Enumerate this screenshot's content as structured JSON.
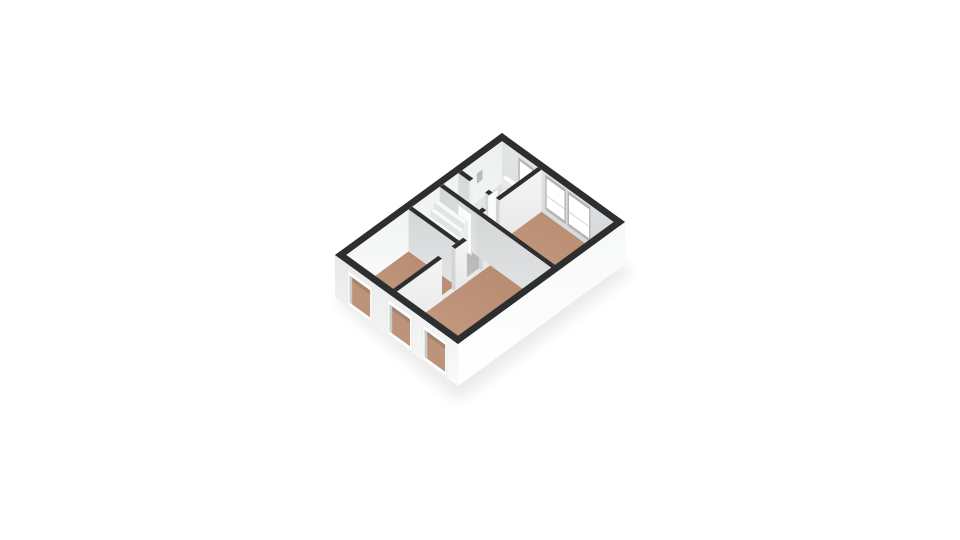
{
  "view": {
    "type": "isometric-3d-floor-plan",
    "background": "#ffffff"
  },
  "palette": {
    "wall_top": "#2c2e30",
    "face_nw_top": "#edeff0",
    "face_nw_bottom": "#fafbfb",
    "face_ne_top": "#e4e6e7",
    "face_ne_bottom": "#d3d5d7",
    "face_v_top": "#d4d6d7",
    "face_v_bottom": "#e3e4e5",
    "face_u_top": "#f4f4f4",
    "face_u_bottom": "#e7e8e8",
    "cap_se": "#eff1f1",
    "cap_sw": "#d2d4d5",
    "ext_sw_top": "#e8e9ea",
    "ext_sw_bottom": "#fafafa",
    "ext_se_top": "#f7f8f8",
    "ext_se_bottom": "#ffffff",
    "floor_wood_dark": "#b58a6f",
    "floor_wood_light": "#cc9f86",
    "floor_grey_dark": "#aeb0b2",
    "floor_grey_light": "#c8cacb",
    "floor_hall_dark": "#babcbe",
    "floor_hall_light": "#d0d2d3",
    "floor_tile_dark": "#d9dbdd",
    "floor_tile_light": "#eff0f1",
    "window_frame_int": "#b2b5b7",
    "window_pane": "#ffffff",
    "window_frame_ext": "#fdfefe",
    "window_reveal": "#c9cccd",
    "window_through_floor": "#bd9379",
    "window_through_top": "#a3846f",
    "door_leaf": "#fbfcfc",
    "door_leaf_stroke": "#d6d8d8",
    "stair_top": "#f8f9f9",
    "stair_riser": "#e2e4e5",
    "stair_side": "#eceeee",
    "stair_stroke": "#d3d5d6",
    "fixture_white": "#fdfdfd",
    "fixture_shade": "#e8eaeb",
    "fixture_stroke": "#d0d3d4",
    "sink_grey": "#b9bcbe",
    "switch_grey": "#9aa0a3",
    "shadow": "#000000"
  },
  "rooms": [
    {
      "name": "bedroom-left",
      "floor": "wood",
      "a": [
        0.034,
        0.407
      ],
      "b": [
        0.046,
        0.427
      ]
    },
    {
      "name": "stair-closet",
      "floor": "grey",
      "a": [
        0.429,
        0.593
      ],
      "b": [
        0.046,
        0.427
      ]
    },
    {
      "name": "hall",
      "floor": "hall",
      "a": [
        0.615,
        0.705
      ],
      "b": [
        0.046,
        0.337
      ]
    },
    {
      "name": "bathroom",
      "floor": "tile",
      "a": [
        0.727,
        0.966
      ],
      "b": [
        0.046,
        0.337
      ]
    },
    {
      "name": "living-room",
      "floor": "wood",
      "a": [
        0.034,
        0.593
      ],
      "b": [
        0.457,
        0.954
      ]
    },
    {
      "name": "bedroom-right",
      "floor": "wood",
      "a": [
        0.615,
        0.966
      ],
      "b": [
        0.367,
        0.954
      ]
    }
  ],
  "walls": {
    "v": [
      {
        "name": "wall-bathroom-hall-upper",
        "a": 0.705,
        "b0": 0.046,
        "b1": 0.137
      },
      {
        "name": "wall-bathroom-hall-lower",
        "a": 0.705,
        "b0": 0.264,
        "b1": 0.337
      },
      {
        "name": "wall-hall-staircloset",
        "a": 0.593,
        "b0": 0.046,
        "b1": 0.337
      },
      {
        "name": "wall-staircloset-bedroomleft",
        "a": 0.407,
        "b0": 0.046,
        "b1": 0.427
      },
      {
        "name": "wall-living-bedroomright",
        "a": 0.593,
        "b0": 0.337,
        "b1": 0.954
      }
    ],
    "u": [
      {
        "name": "wall-bathroom-bedroom",
        "b": 0.337,
        "segments": [
          [
            0.593,
            0.635
          ],
          [
            0.715,
            0.966
          ]
        ]
      },
      {
        "name": "wall-nwrooms-living",
        "b": 0.427,
        "segments": [
          [
            0.034,
            0.304
          ],
          [
            0.384,
            0.453
          ],
          [
            0.547,
            0.615
          ]
        ]
      }
    ]
  },
  "windows": {
    "ne_interior": [
      {
        "name": "bathroom-window",
        "b0": 0.191,
        "b1": 0.291,
        "d0": 7,
        "d1": 26,
        "midbar": false
      },
      {
        "name": "bedroom-window-1",
        "b0": 0.409,
        "b1": 0.554,
        "d0": 5,
        "d1": 34,
        "midbar": true
      },
      {
        "name": "bedroom-window-2",
        "b0": 0.591,
        "b1": 0.754,
        "d0": 5,
        "d1": 34,
        "midbar": true
      }
    ],
    "sw_exterior": [
      {
        "name": "facade-window-1",
        "b0": 0.12,
        "b1": 0.285
      },
      {
        "name": "facade-window-2",
        "b0": 0.445,
        "b1": 0.61
      },
      {
        "name": "facade-window-3",
        "b0": 0.73,
        "b1": 0.895
      }
    ]
  },
  "doors": [
    {
      "name": "bathroom-door-leaf",
      "type": "u-leaf",
      "b": 0.285,
      "a0": 0.705,
      "a1": 0.768
    },
    {
      "name": "staircloset-door-leaf",
      "type": "v-leaf",
      "a": 0.578,
      "b0": 0.215,
      "b1": 0.325
    }
  ],
  "fixtures": {
    "stairs": {
      "name": "staircase",
      "steps": 6,
      "a_start": 0.44,
      "step_depth": 0.0225,
      "b0": 0.055,
      "b1": 0.3,
      "rise": 5.3
    },
    "toilet": {
      "name": "toilet",
      "tank_a": [
        0.925,
        0.95
      ],
      "tank_b": [
        0.1,
        0.2
      ],
      "bowl_a": 0.905,
      "bowl_b": 0.15
    },
    "sink": {
      "name": "wall-sink",
      "a0": 0.815,
      "a1": 0.85,
      "d0": 14,
      "d1": 24
    },
    "switch": {
      "name": "wall-switch-dot",
      "on_wall_a": 0.593,
      "b0": 0.23,
      "b1": 0.255,
      "d0": 17,
      "d1": 21
    }
  }
}
